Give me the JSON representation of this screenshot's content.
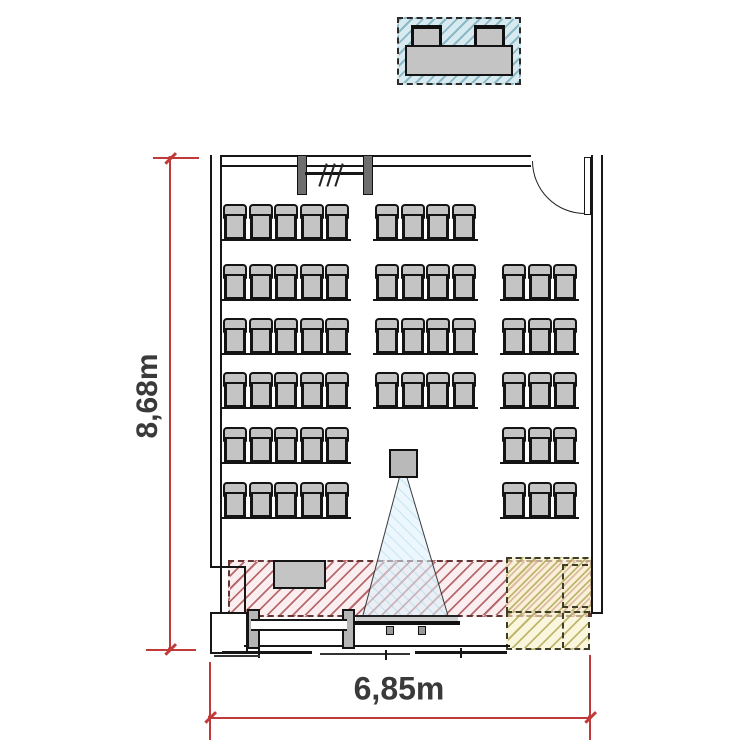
{
  "title": "classroom-floor-plan",
  "dimensions": {
    "height_label": "8,68m",
    "width_label": "6,85m"
  },
  "colors": {
    "wall_line": "#161616",
    "furniture_fill": "#c4c4c4",
    "furniture_line": "#141414",
    "zone_blue_bg": "#d6eaf0",
    "zone_blue_line": "#8ab8c5",
    "zone_red_bg": "#faeef0",
    "zone_red_line": "#b86a6c",
    "zone_red_border": "#643434",
    "zone_yellow_bg": "rgba(246,241,198,0.60)",
    "zone_yellow_line": "rgba(186,174,96,0.90)",
    "zone_yellow_border": "#3d3d2a",
    "cone_fill": "rgba(219,241,249,0.55)",
    "cone_hatch": "rgba(140,200,225,0.40)",
    "cone_border": "#3a3a3a",
    "dim_color": "#bf3a38",
    "dim_text": "#3a3a3a"
  },
  "seating": {
    "chair_w": 24,
    "chair_h": 35,
    "rows": [
      {
        "y": 204,
        "groups": [
          {
            "x": 223,
            "seats": 5
          },
          {
            "x": 375,
            "seats": 4
          }
        ]
      },
      {
        "y": 264,
        "groups": [
          {
            "x": 223,
            "seats": 5
          },
          {
            "x": 375,
            "seats": 4
          },
          {
            "x": 502,
            "seats": 3
          }
        ]
      },
      {
        "y": 318,
        "groups": [
          {
            "x": 223,
            "seats": 5
          },
          {
            "x": 375,
            "seats": 4
          },
          {
            "x": 502,
            "seats": 3
          }
        ]
      },
      {
        "y": 372,
        "groups": [
          {
            "x": 223,
            "seats": 5
          },
          {
            "x": 375,
            "seats": 4
          },
          {
            "x": 502,
            "seats": 3
          }
        ]
      },
      {
        "y": 427,
        "groups": [
          {
            "x": 223,
            "seats": 5
          },
          {
            "x": 502,
            "seats": 3
          }
        ]
      },
      {
        "y": 482,
        "groups": [
          {
            "x": 223,
            "seats": 5
          },
          {
            "x": 502,
            "seats": 3
          }
        ]
      }
    ],
    "total_seats": 61
  },
  "objects": {
    "service_desk_zone": "blue-hatched zone outside room with desk and two chairs",
    "stage_zone": "red-hatched lecturer zone",
    "equipment_zone": "yellow-hatched zone bottom right",
    "projector": "ceiling projector with beam cone onto screen",
    "screen": "projection screen at front wall",
    "whiteboard": "board with two posts at front left",
    "teacher_desk": "desk inside stage zone",
    "door": "door with swing arc, top right",
    "window_top": "window/board symbol on top wall",
    "window_bottom": "window band along bottom wall"
  }
}
